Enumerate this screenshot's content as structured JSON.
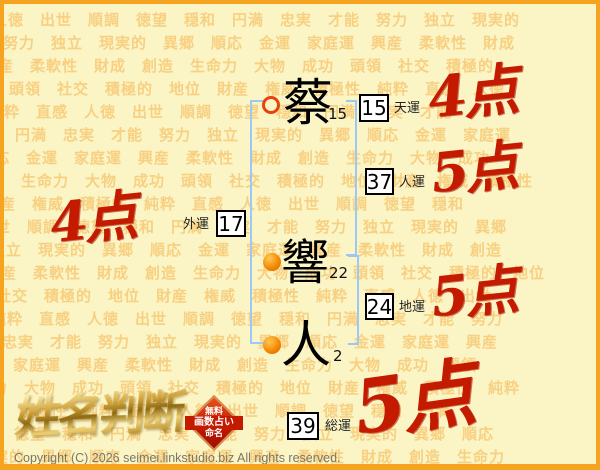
{
  "background": {
    "words": [
      "人徳",
      "出世",
      "順調",
      "徳望",
      "穏和",
      "円満",
      "忠実",
      "才能",
      "努力",
      "独立",
      "現実的",
      "異郷",
      "順応",
      "金運",
      "家庭運",
      "興産",
      "柔軟性",
      "財成",
      "創造",
      "生命力",
      "大物",
      "成功",
      "頭領",
      "社交",
      "積極的",
      "地位",
      "財産",
      "権威",
      "積極性",
      "純粋",
      "直感"
    ]
  },
  "name": {
    "chars": [
      {
        "char": "蔡",
        "strokes": "15",
        "marker": "ring"
      },
      {
        "char": "響",
        "strokes": "22",
        "marker": "dot"
      },
      {
        "char": "人",
        "strokes": "2",
        "marker": "dot"
      }
    ]
  },
  "fortunes": [
    {
      "id": "tenun",
      "label": "天運",
      "value": "15",
      "score": "4点"
    },
    {
      "id": "jinun",
      "label": "人運",
      "value": "37",
      "score": "5点"
    },
    {
      "id": "chiun",
      "label": "地運",
      "value": "24",
      "score": "5点"
    },
    {
      "id": "gaiun",
      "label": "外運",
      "value": "17",
      "score": "4点"
    },
    {
      "id": "souun",
      "label": "総運",
      "value": "39",
      "score": "5点"
    }
  ],
  "logo": {
    "title": "姓名判断",
    "badge": [
      "無料",
      "画数占い",
      "命名"
    ]
  },
  "footer": {
    "copyright": "Copyright (C) 2026 seimei.linkstudio.biz All rights reserved."
  },
  "colors": {
    "accent_red": "#C41A00",
    "bracket_blue": "#9CC7F7",
    "border_orange": "#F6A41F",
    "background": "#FBF5C5",
    "pattern_word": "#F2A838",
    "logo_gold": "#C9992E"
  }
}
